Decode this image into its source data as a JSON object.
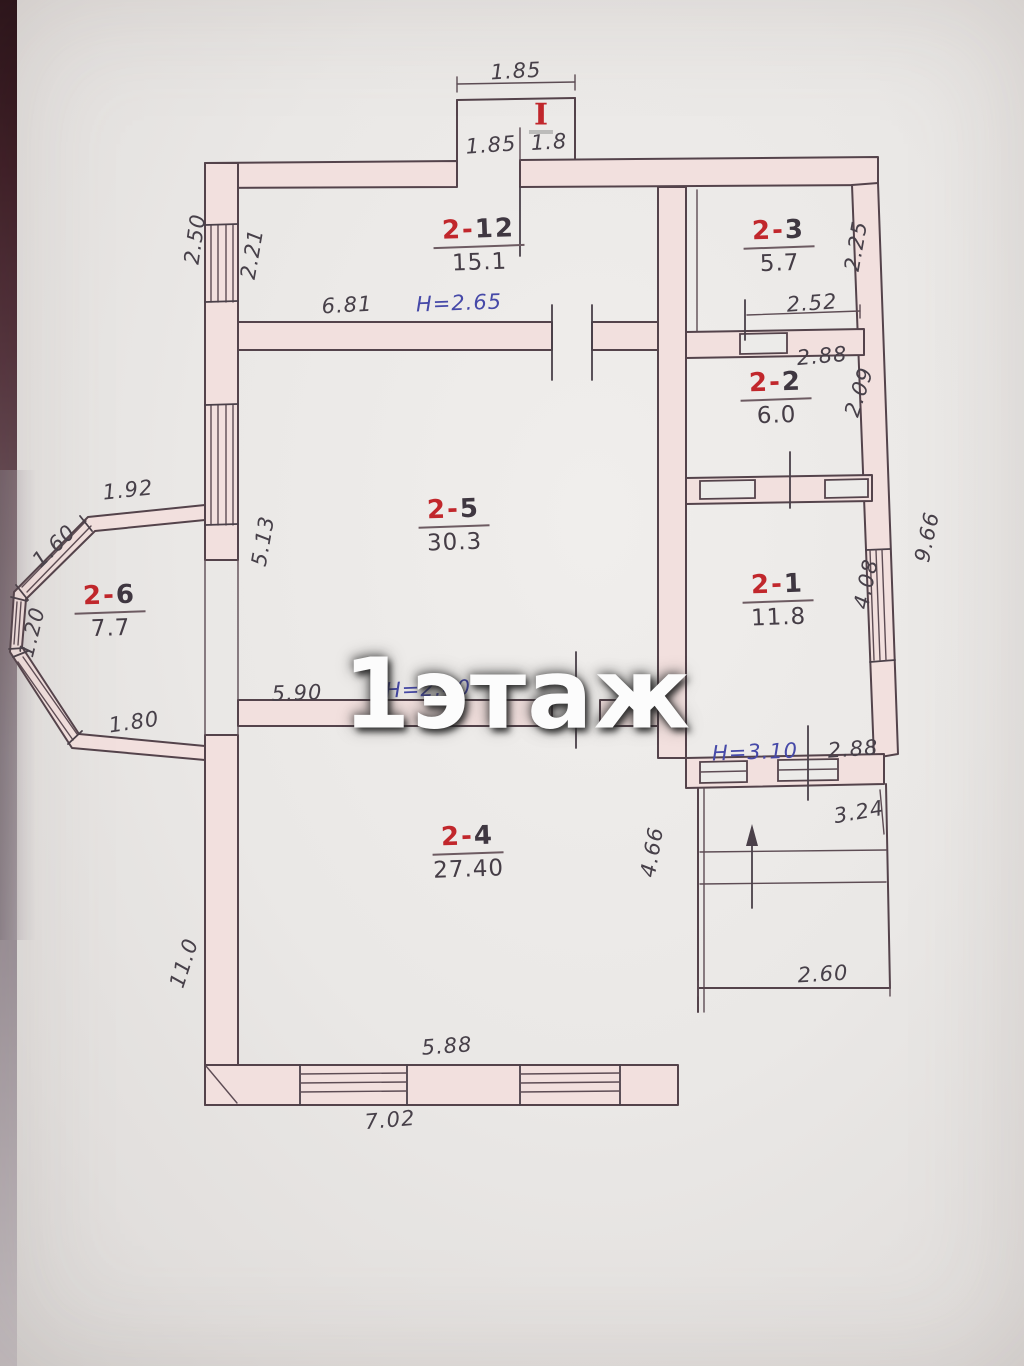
{
  "watermark": "1этаж",
  "porch": {
    "label": "I",
    "dim_top": "1.85",
    "dim_left": "1.85",
    "dim_right": "1.8"
  },
  "rooms": {
    "r212": {
      "prefix": "2-",
      "num": "12",
      "area": "15.1"
    },
    "r23": {
      "prefix": "2-",
      "num": "3",
      "area": "5.7"
    },
    "r22": {
      "prefix": "2-",
      "num": "2",
      "area": "6.0"
    },
    "r21": {
      "prefix": "2-",
      "num": "1",
      "area": "11.8"
    },
    "r25": {
      "prefix": "2-",
      "num": "5",
      "area": "30.3"
    },
    "r26": {
      "prefix": "2-",
      "num": "6",
      "area": "7.7"
    },
    "r24": {
      "prefix": "2-",
      "num": "4",
      "area": "27.40"
    }
  },
  "dims": {
    "left_top_out": "2.50",
    "left_top_in": "2.21",
    "r212_width": "6.81",
    "r212_height": "H=2.65",
    "r23_right": "2.25",
    "r23_bottom": "2.52",
    "r22_top": "2.88",
    "r22_right": "2.09",
    "r21_right": "4.08",
    "right_out": "9.66",
    "r25_left": "5.13",
    "r25_bottom": "5.90",
    "r25_height": "H=2.40",
    "r26_top": "1.92",
    "r26_diag": "1.60",
    "r26_left": "1.20",
    "r26_bottom": "1.80",
    "r24_right": "4.66",
    "r24_left_out": "11.0",
    "r24_bottom_in": "5.88",
    "r24_bottom_out": "7.02",
    "stairs_height": "H=3.10",
    "stairs_top": "2.88",
    "stairs_mid": "3.24",
    "stairs_bottom": "2.60"
  },
  "colors": {
    "room_number_red": "#c1272c",
    "height_note_blue": "#4649a8",
    "ink": "#474049",
    "wall_fill": "#f2e0de",
    "paper": "#eae8e6"
  }
}
